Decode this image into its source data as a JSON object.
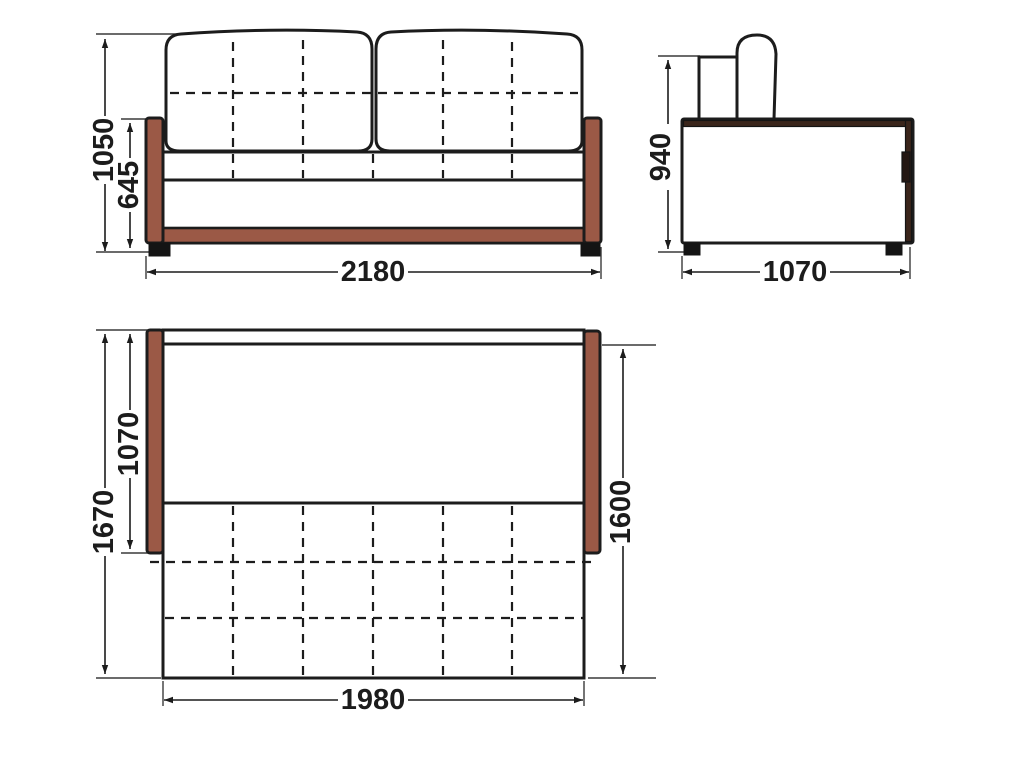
{
  "colors": {
    "wood": "#9b5946",
    "wood_dark": "#3a251b",
    "handle_dark": "#241712",
    "line": "#1c1c1c"
  },
  "front_view": {
    "overall_height": "1050",
    "armrest_height": "645",
    "overall_width": "2180"
  },
  "side_view": {
    "backrest_height": "940",
    "depth": "1070"
  },
  "plan_view": {
    "overall_length": "1670",
    "seat_platform_length": "1070",
    "bed_length": "1600",
    "bed_width": "1980"
  }
}
